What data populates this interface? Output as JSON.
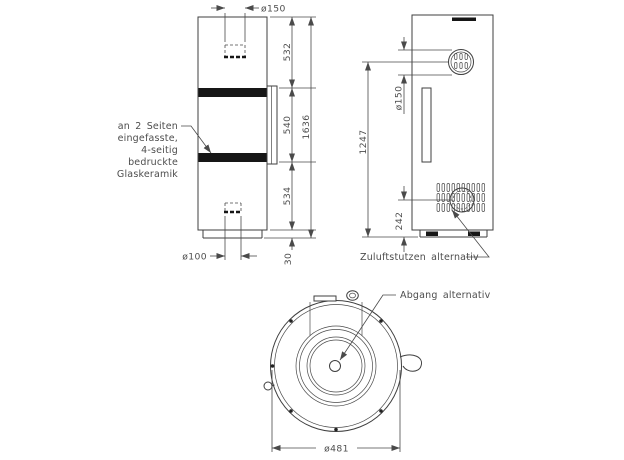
{
  "colors": {
    "line": "#3f3f3f",
    "text": "#4d4d4d",
    "dark_fill": "#161616",
    "background": "#ffffff"
  },
  "front_view": {
    "glass_label_lines": [
      "an 2 Seiten",
      "eingefasste,",
      "4-seitig",
      "bedruckte",
      "Glaskeramik"
    ],
    "dim_flue_diameter": "ø150",
    "dim_top_section": "532",
    "dim_door_section": "540",
    "dim_lower_section": "534",
    "dim_plinth_height": "30",
    "dim_total_height": "1636",
    "dim_air_inlet_diameter": "ø100"
  },
  "side_view": {
    "dim_flue_diameter": "ø150",
    "dim_flue_center_height": "1247",
    "dim_air_inlet_center_height": "242",
    "label_air_inlet": "Zuluftstutzen alternativ"
  },
  "top_view": {
    "dim_diameter": "ø481",
    "label_outlet": "Abgang alternativ"
  }
}
